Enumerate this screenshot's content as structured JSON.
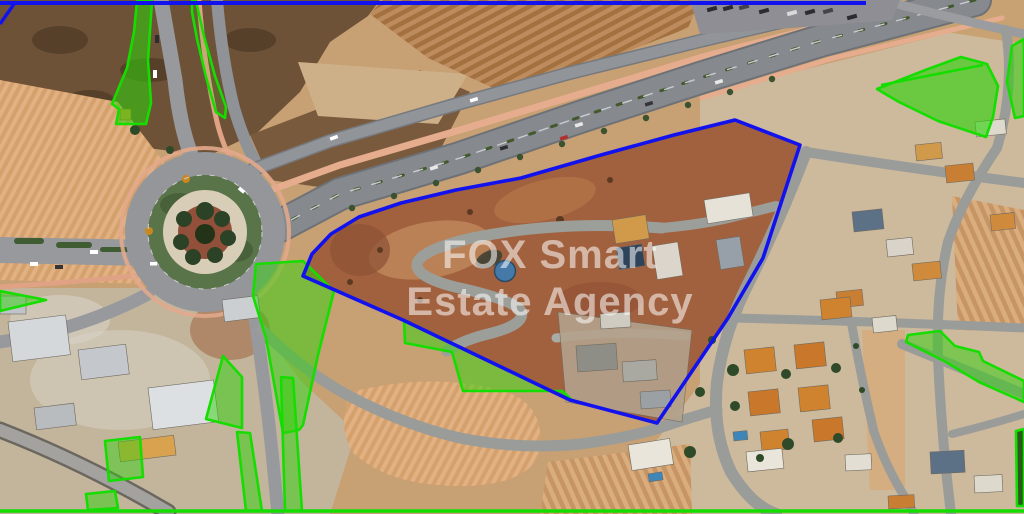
{
  "title": "Aerial property map",
  "watermark": {
    "line1": "FOX Smart",
    "line2": "Estate Agency"
  },
  "colors": {
    "boundary_blue": "#1212ee",
    "green_stroke": "#15dd00",
    "green_fill": "#2fd20a",
    "marker_fill": "#4579a8",
    "marker_stroke": "#2b4a63",
    "parcel_ground": "#a2613e"
  },
  "marker": {
    "cx": 505,
    "cy": 271,
    "r": 10.5
  },
  "boundary": {
    "name": "property-boundary-polygon",
    "stroke_width": 3.6,
    "points": [
      [
        735,
        120
      ],
      [
        800,
        145
      ],
      [
        763,
        258
      ],
      [
        728,
        318
      ],
      [
        657,
        423
      ],
      [
        570,
        400
      ],
      [
        403,
        320
      ],
      [
        303,
        276
      ],
      [
        312,
        254
      ],
      [
        331,
        234
      ],
      [
        359,
        217
      ],
      [
        401,
        203
      ],
      [
        456,
        190
      ],
      [
        521,
        178
      ],
      [
        601,
        155
      ],
      [
        674,
        135
      ]
    ]
  },
  "lines": [
    {
      "name": "top-boundary-line",
      "color": "blue",
      "width": 4,
      "points": [
        [
          0,
          3
        ],
        [
          866,
          3
        ]
      ]
    },
    {
      "name": "top-left-boundary-segment",
      "color": "blue",
      "width": 3.5,
      "points": [
        [
          0,
          24
        ],
        [
          14,
          4
        ]
      ]
    },
    {
      "name": "bottom-boundary-line",
      "color": "green",
      "width": 3.5,
      "points": [
        [
          0,
          511
        ],
        [
          1024,
          511
        ]
      ]
    },
    {
      "name": "top-right-zone-divider",
      "color": "green",
      "width": 2.5,
      "points": [
        [
          881,
          85
        ],
        [
          983,
          65
        ]
      ]
    }
  ],
  "green_zones": [
    {
      "name": "green-zone-topleft-wedge",
      "opacity": 0.55,
      "points": [
        [
          137,
          1
        ],
        [
          152,
          1
        ],
        [
          148,
          60
        ],
        [
          151,
          103
        ],
        [
          146,
          124
        ],
        [
          116,
          124
        ],
        [
          119,
          109
        ],
        [
          112,
          104
        ],
        [
          127,
          68
        ],
        [
          134,
          32
        ]
      ]
    },
    {
      "name": "green-zone-topleft-crescent",
      "opacity": 0.12,
      "points": [
        [
          196,
          1
        ],
        [
          204,
          36
        ],
        [
          215,
          76
        ],
        [
          226,
          107
        ],
        [
          225,
          118
        ],
        [
          216,
          112
        ],
        [
          206,
          77
        ],
        [
          197,
          39
        ],
        [
          192,
          12
        ],
        [
          192,
          1
        ]
      ]
    },
    {
      "name": "green-zone-topright-fan",
      "opacity": 0.62,
      "points": [
        [
          877,
          89
        ],
        [
          928,
          69
        ],
        [
          961,
          57
        ],
        [
          987,
          64
        ],
        [
          998,
          86
        ],
        [
          993,
          117
        ],
        [
          986,
          137
        ],
        [
          938,
          121
        ],
        [
          899,
          102
        ]
      ]
    },
    {
      "name": "green-zone-right-edge-sliver",
      "opacity": 0.55,
      "points": [
        [
          1012,
          46
        ],
        [
          1024,
          39
        ],
        [
          1024,
          116
        ],
        [
          1015,
          118
        ],
        [
          1007,
          82
        ]
      ]
    },
    {
      "name": "green-zone-roundabout-east",
      "opacity": 0.5,
      "points": [
        [
          256,
          264
        ],
        [
          303,
          261
        ],
        [
          334,
          291
        ],
        [
          318,
          355
        ],
        [
          303,
          425
        ],
        [
          299,
          430
        ],
        [
          283,
          433
        ],
        [
          266,
          338
        ],
        [
          253,
          296
        ]
      ]
    },
    {
      "name": "green-zone-below-boundary",
      "opacity": 0.5,
      "points": [
        [
          404,
          320
        ],
        [
          573,
          401
        ],
        [
          562,
          391
        ],
        [
          463,
          391
        ],
        [
          452,
          352
        ],
        [
          405,
          343
        ]
      ]
    },
    {
      "name": "green-zone-south-triangle",
      "opacity": 0.5,
      "points": [
        [
          223,
          356
        ],
        [
          242,
          377
        ],
        [
          242,
          428
        ],
        [
          206,
          419
        ]
      ]
    },
    {
      "name": "green-zone-south-strip-left",
      "opacity": 0.5,
      "points": [
        [
          237,
          432
        ],
        [
          250,
          433
        ],
        [
          262,
          511
        ],
        [
          246,
          511
        ]
      ]
    },
    {
      "name": "green-zone-south-strip-right",
      "opacity": 0.5,
      "points": [
        [
          281,
          377
        ],
        [
          293,
          378
        ],
        [
          302,
          511
        ],
        [
          285,
          511
        ]
      ]
    },
    {
      "name": "green-zone-small-square",
      "opacity": 0.45,
      "points": [
        [
          105,
          441
        ],
        [
          140,
          437
        ],
        [
          143,
          477
        ],
        [
          109,
          481
        ]
      ]
    },
    {
      "name": "green-zone-bottomleft-small",
      "opacity": 0.5,
      "points": [
        [
          86,
          494
        ],
        [
          115,
          491
        ],
        [
          118,
          508
        ],
        [
          88,
          510
        ]
      ]
    },
    {
      "name": "green-zone-bottomright-strip",
      "opacity": 0.5,
      "points": [
        [
          908,
          335
        ],
        [
          940,
          331
        ],
        [
          955,
          346
        ],
        [
          979,
          352
        ],
        [
          983,
          361
        ],
        [
          1024,
          381
        ],
        [
          1024,
          402
        ],
        [
          979,
          382
        ],
        [
          946,
          362
        ],
        [
          906,
          342
        ]
      ]
    },
    {
      "name": "green-zone-left-edge-sliver",
      "opacity": 0.5,
      "points": [
        [
          0,
          291
        ],
        [
          46,
          300
        ],
        [
          0,
          311
        ]
      ]
    },
    {
      "name": "green-zone-right-edge-bottom",
      "opacity": 0.15,
      "points": [
        [
          1016,
          431
        ],
        [
          1024,
          429
        ],
        [
          1024,
          506
        ],
        [
          1017,
          506
        ]
      ]
    }
  ]
}
